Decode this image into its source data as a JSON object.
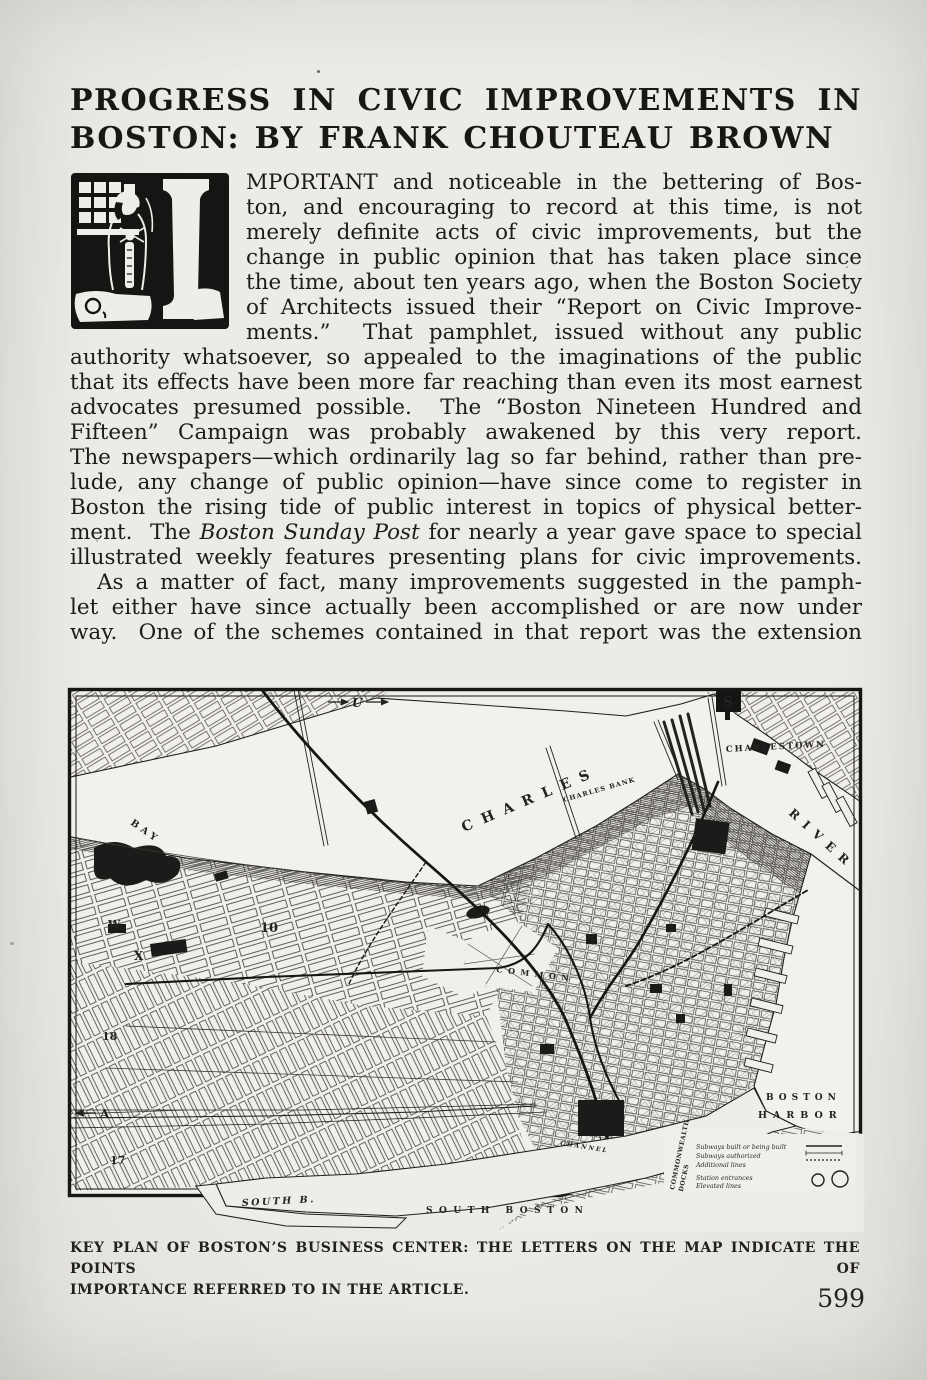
{
  "title": {
    "line1": "PROGRESS IN CIVIC IMPROVEMENTS IN",
    "line2": "BOSTON: BY FRANK CHOUTEAU BROWN"
  },
  "article": {
    "drop_cap_letter": "I",
    "para1_lines": [
      "MPORTANT and noticeable in the bettering of Bos-",
      "ton, and encouraging to record at this time, is not",
      "merely definite acts of civic improvements, but the",
      "change in public opinion that has taken place since",
      "the time, about ten years ago, when the Boston Society",
      "of Architects issued their “Report on Civic Improve-",
      "ments.”  That pamphlet, issued without any public",
      "authority whatsoever, so appealed to the imaginations of the public",
      "that its effects have been more far reaching than even its most earnest",
      "advocates presumed possible.  The “Boston Nineteen Hundred and",
      "Fifteen” Campaign was probably awakened by this very report.",
      "The newspapers—which ordinarily lag so far behind, rather than pre-",
      "lude, any change of public opinion—have since come to register in",
      "Boston the rising tide of public interest in topics of physical better-"
    ],
    "para1_line15_parts": {
      "pre": "ment.  The ",
      "italic": "Boston Sunday Post",
      "post": " for nearly a year gave space to special"
    },
    "para1_line16": "illustrated weekly features presenting plans for civic improvements.",
    "para2_lines": [
      "As a matter of fact, many improvements suggested in the pamph-",
      "let either have since actually been accomplished or are now under",
      "way.  One of the schemes contained in that report was the extension"
    ]
  },
  "figure": {
    "caption_line1": "KEY PLAN OF BOSTON’S BUSINESS CENTER: THE LETTERS ON THE MAP INDICATE THE POINTS OF",
    "caption_line2": "IMPORTANCE REFERRED TO IN THE ARTICLE.",
    "map": {
      "arrow_u": "U",
      "badge_s": "S",
      "charlestown": "CHARLESTOWN",
      "charles": "CHARLES",
      "river": "RIVER",
      "charles_bank": "CHARLES BANK",
      "back_bay": "BAY",
      "common": "COMMON",
      "harbor_line1": "BOSTON",
      "harbor_line2": "HARBOR",
      "south_bay": "SOUTH B.",
      "south_boston": "SOUTH  BOSTON",
      "channel": "CHANNEL",
      "docks_line1": "COMMONWEALTH",
      "docks_line2": "DOCKS",
      "key_w": "W",
      "key_x": "X",
      "key_10": "10",
      "key_17": "17",
      "key_18": "18",
      "key_a": "A",
      "legend_lines": [
        "Subways built or being built",
        "Subways authorized",
        "Additional lines",
        "Station entrances",
        "Elevated lines"
      ]
    }
  },
  "page": {
    "number": "599"
  }
}
